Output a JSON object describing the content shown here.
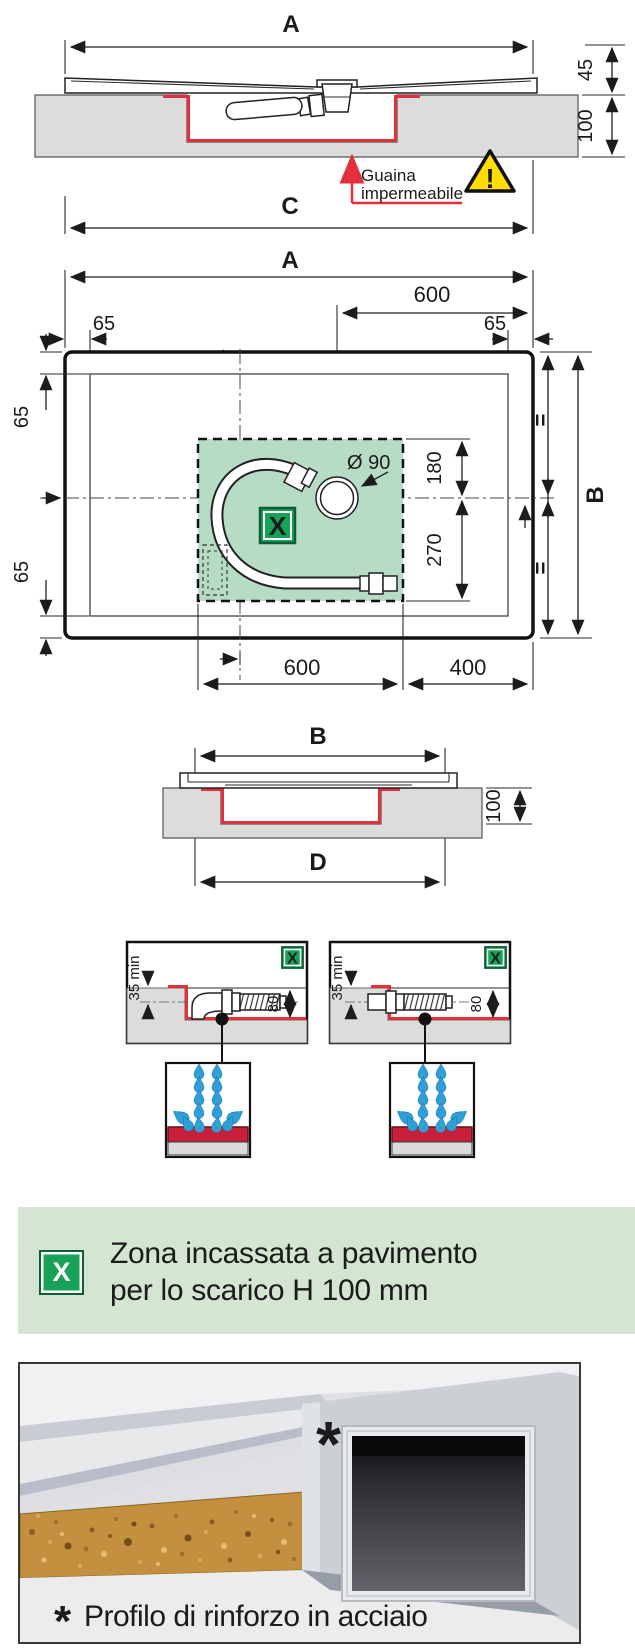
{
  "colors": {
    "drawing_red": "#e42f3d",
    "membrane_text_red": "#e04a5e",
    "zone_green": "#b7dcc6",
    "badge_green": "#17a257",
    "banner_green": "#d4e5d1",
    "drop_blue": "#2f9fd6",
    "warning_yellow": "#ffdd00"
  },
  "section_top": {
    "dim_a": "A",
    "dim_45": "45",
    "dim_100": "100",
    "dim_c": "C",
    "membrane_line1": "Guaina",
    "membrane_line2": "impermeabile",
    "warning_mark": "!"
  },
  "plan": {
    "dim_a": "A",
    "dim_600_top": "600",
    "dim_65_top_left": "65",
    "dim_65_top_right": "65",
    "dim_65_left_top": "65",
    "dim_65_left_bottom": "65",
    "dia_label": "Ø 90",
    "dim_180": "180",
    "dim_270": "270",
    "eq_top": "=",
    "eq_bottom": "=",
    "dim_b": "B",
    "zone_marker": "X",
    "dim_600_bottom": "600",
    "dim_400_bottom": "400"
  },
  "section_b": {
    "dim_b": "B",
    "dim_100": "100",
    "dim_d": "D"
  },
  "details": {
    "left": {
      "marker": "X",
      "dim_35": "35 min",
      "dim_80": "80"
    },
    "right": {
      "marker": "X",
      "dim_35": "35 min",
      "dim_80": "80"
    }
  },
  "legend": {
    "marker": "X",
    "line1": "Zona incassata a pavimento",
    "line2": "per lo scarico H 100 mm"
  },
  "photo": {
    "asterisk": "*",
    "caption": "Profilo di rinforzo in acciaio"
  }
}
